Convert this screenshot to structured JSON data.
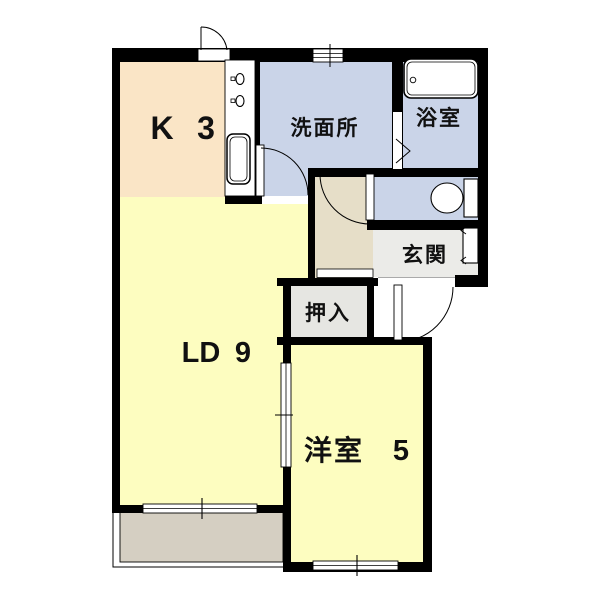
{
  "floorplan": {
    "rooms": {
      "kitchen": {
        "label": "K",
        "size": "3"
      },
      "washroom": {
        "label": "洗面所"
      },
      "bathroom": {
        "label": "浴室"
      },
      "entrance": {
        "label": "玄関"
      },
      "closet": {
        "label": "押入"
      },
      "living_dining": {
        "label": "LD",
        "size": "9"
      },
      "western_room": {
        "label": "洋室",
        "size": "5"
      }
    },
    "colors": {
      "wall": "#000000",
      "kitchen_floor": "#FAE5C6",
      "yellow_room_floor": "#FDFDC0",
      "wet_area_floor": "#CAD4E8",
      "hallway_floor": "#E6DEC8",
      "entrance_floor": "#EBEBE8",
      "closet_floor": "#E6E6E2",
      "balcony_floor": "#D5CFC2"
    }
  }
}
